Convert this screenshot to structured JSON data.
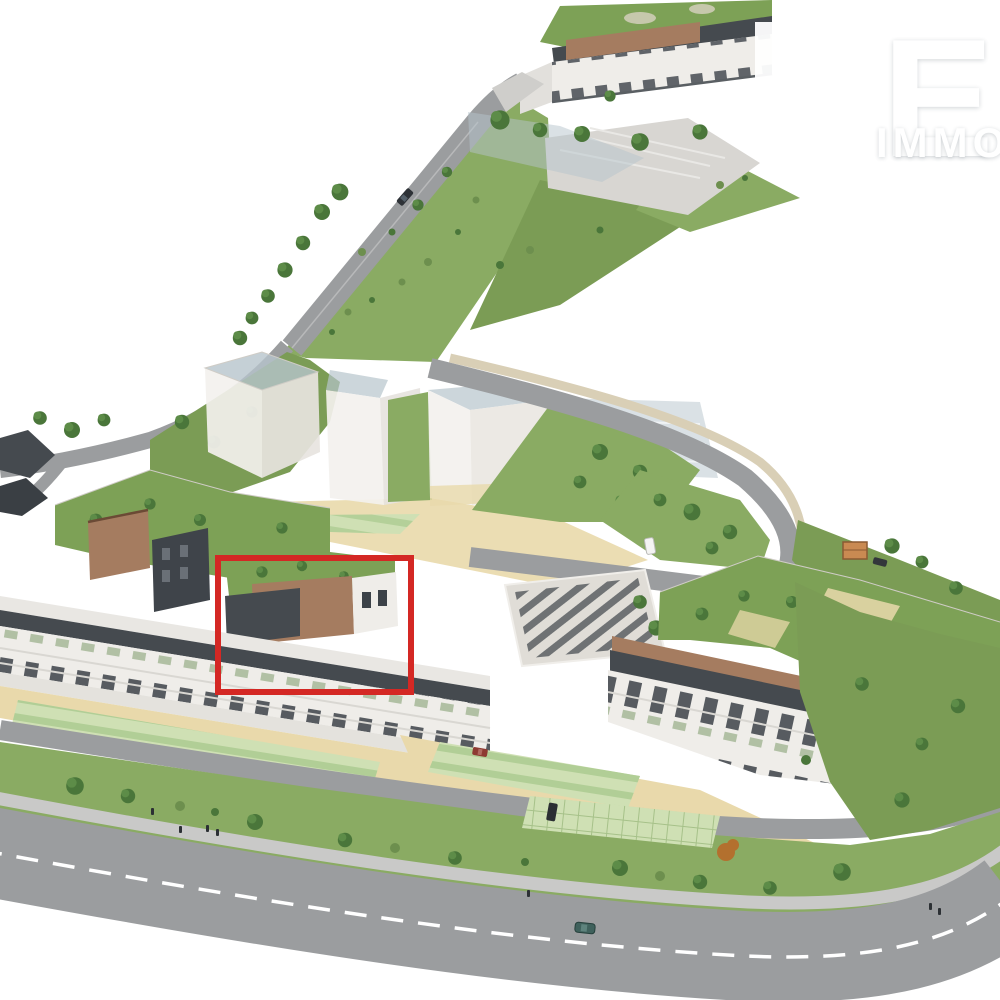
{
  "scene": {
    "type": "3D aerial architectural render of a residential development site plan",
    "built_part": "apartment buildings with planted roof terraces, balconies and a landscaped promenade",
    "future_part": "semi-transparent white massing blocks of a future construction phase",
    "highlight_note": "one rooftop-terrace apartment building outlined with a red rectangle"
  },
  "watermark": {
    "mark": "double-L monogram",
    "text_large": "EG",
    "text_small": "IMMOBI",
    "color": "#ffffff"
  },
  "annotation": {
    "shape": "rectangle",
    "color": "#d42824",
    "x": 218,
    "y": 558,
    "width": 193,
    "height": 134,
    "stroke_width": 6
  },
  "colors": {
    "grass": "#8aab63",
    "grass2": "#7b9c55",
    "roofg": "#7da156",
    "road": "#9b9d9f",
    "sand": "#e9d9ab",
    "dark": "#454a4f",
    "brick": "#a57c60",
    "facade": "#efede9",
    "ghost": "#f3f1ee",
    "glass": "#b6c4cc",
    "parking": "#d8d6d2",
    "plots": "#cfe0b4",
    "tree1": "#4a763a",
    "tree2": "#5d8c48",
    "olive": "#6d8f4e",
    "red": "#d42824"
  },
  "vehicles": [
    {
      "color": "#2e3237",
      "location": "upper road"
    },
    {
      "color": "#f4f4f2",
      "location": "central court"
    },
    {
      "color": "#8e3a32",
      "location": "access road"
    },
    {
      "color": "#2b2f33",
      "location": "hedge parking"
    },
    {
      "color": "#3f615c",
      "location": "main road"
    },
    {
      "color": "#33373b",
      "location": "east slope road"
    }
  ],
  "pedestrian_count": 7
}
